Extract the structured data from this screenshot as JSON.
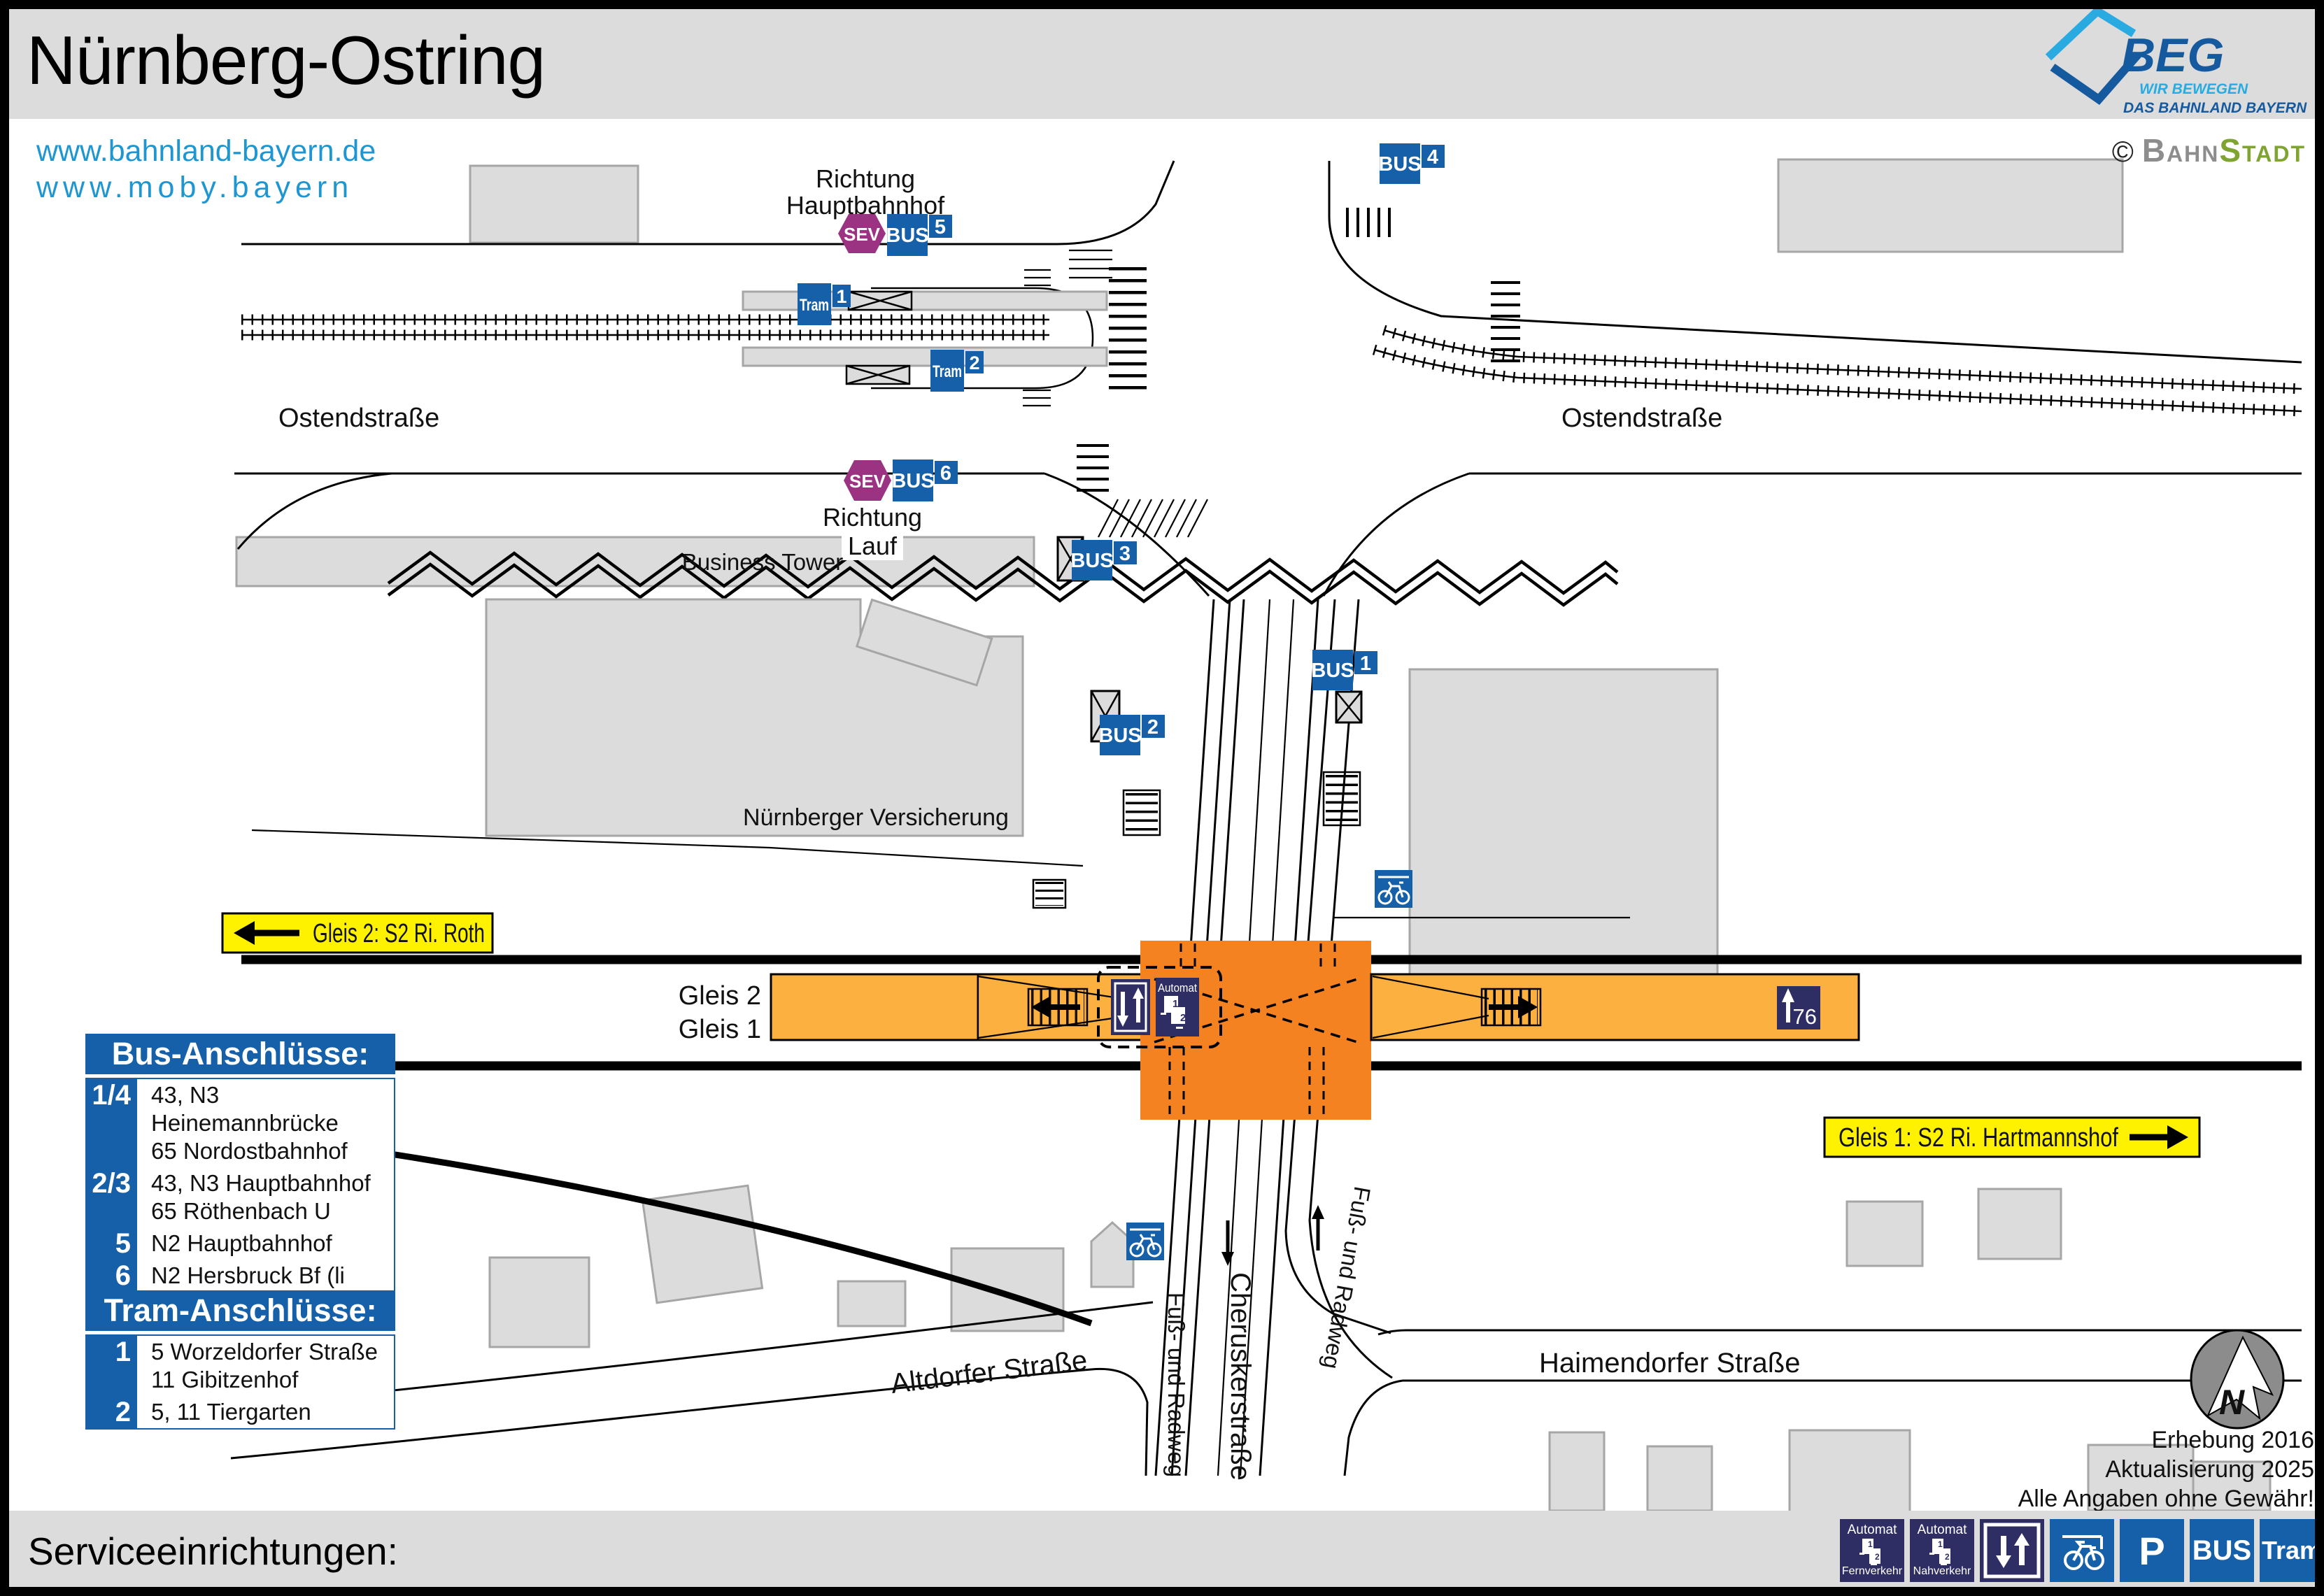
{
  "header": {
    "title": "Nürnberg-Ostring",
    "logo": {
      "name": "BEG",
      "tagline1": "WIR BEWEGEN",
      "tagline2": "DAS BAHNLAND BAYERN"
    }
  },
  "links": {
    "line1": "www.bahnland-bayern.de",
    "line2": "www.moby.bayern"
  },
  "credit": {
    "symbol": "©",
    "brand_gray": "Bahn",
    "brand_green": "Stadt"
  },
  "map": {
    "streets": {
      "ostend_left": "Ostendstraße",
      "ostend_right": "Ostendstraße",
      "altdorfer": "Altdorfer Straße",
      "haimendorfer": "Haimendorfer Straße",
      "cherusker": "Cheruskerstraße",
      "fussweg_left": "Fuß- und Radweg",
      "fussweg_right": "Fuß- und Radweg"
    },
    "buildings": {
      "business_tower": "Business Tower",
      "versicherung": "Nürnberger Versicherung"
    },
    "directions": {
      "hbf_line1": "Richtung",
      "hbf_line2": "Hauptbahnhof",
      "lauf_line1": "Richtung",
      "lauf_line2": "Lauf"
    },
    "labels": {
      "bus": "BUS",
      "tram": "Tram",
      "sev": "SEV",
      "gleis2": "Gleis 2",
      "gleis1": "Gleis 1",
      "automat": "Automat",
      "parking_count": "76"
    },
    "stops": {
      "bus1": "1",
      "bus2": "2",
      "bus3": "3",
      "bus4": "4",
      "bus5": "5",
      "bus6": "6",
      "tram1": "1",
      "tram2": "2"
    },
    "signs": {
      "gleis2_dir": "Gleis 2: S2 Ri. Roth",
      "gleis1_dir": "Gleis 1: S2 Ri. Hartmannshof"
    }
  },
  "machine": {
    "d1": "1",
    "d2": "2"
  },
  "bus_connections": {
    "title": "Bus-Anschlüsse:",
    "rows": [
      {
        "stop": "1/4",
        "line1": "43, N3 Heinemannbrücke",
        "line2": "65 Nordostbahnhof"
      },
      {
        "stop": "2/3",
        "line1": "43, N3 Hauptbahnhof",
        "line2": "65 Röthenbach U"
      },
      {
        "stop": "5",
        "line1": "N2 Hauptbahnhof",
        "line2": ""
      },
      {
        "stop": "6",
        "line1": "N2 Hersbruck Bf (li Pegn)",
        "line2": ""
      }
    ]
  },
  "tram_connections": {
    "title": "Tram-Anschlüsse:",
    "rows": [
      {
        "stop": "1",
        "line1": "5 Worzeldorfer Straße",
        "line2": "11 Gibitzenhof"
      },
      {
        "stop": "2",
        "line1": "5, 11 Tiergarten",
        "line2": ""
      }
    ]
  },
  "notes": {
    "compass": "N",
    "line1": "Erhebung 2016",
    "line2": "Aktualisierung 2025",
    "line3": "Alle Angaben ohne Gewähr!"
  },
  "footer": {
    "title": "Serviceeinrichtungen:",
    "icons": [
      {
        "name": "automat-fernverkehr",
        "top": "Automat",
        "bottom": "Fernverkehr"
      },
      {
        "name": "automat-nahverkehr",
        "top": "Automat",
        "bottom": "Nahverkehr"
      },
      {
        "name": "lift"
      },
      {
        "name": "bike-parking"
      },
      {
        "name": "parking",
        "label": "P"
      },
      {
        "name": "bus",
        "label": "BUS"
      },
      {
        "name": "tram",
        "label": "Tram"
      }
    ]
  },
  "colors": {
    "beg_blue": "#1560a8",
    "navy": "#2e2d64",
    "sev_purple": "#9c3282",
    "sign_yellow": "#fff200",
    "platform_orange": "#fbb040",
    "crossing_orange": "#f58220",
    "link_blue": "#1e96d2",
    "tagline_blue": "#29abe2",
    "building_gray": "#dcdcdc",
    "brand_green": "#7fa431"
  }
}
